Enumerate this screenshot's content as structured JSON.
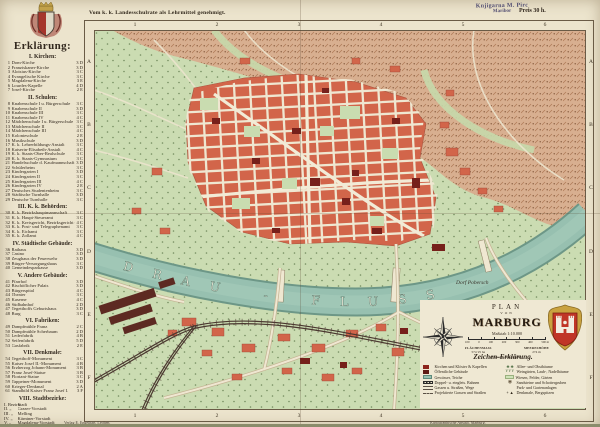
{
  "page": {
    "top_note": "Vom k. k. Landesschulrate als Lehrmittel genehmigt.",
    "stamp_line1": "Knjigarna M. Pirc",
    "stamp_line2": "Maribor",
    "price": "Preis 30 h.",
    "imprint_left": "Verlag E. Engelhart, Leoben.",
    "imprint_right": "Kartographische Anstalt, Marburg."
  },
  "legend": {
    "title": "Erklärung:",
    "sections": [
      {
        "title": "I. Kirchen:",
        "items": [
          {
            "n": "1",
            "label": "Dom-Kirche",
            "ref": "3 D"
          },
          {
            "n": "2",
            "label": "Franziskaner-Kirche",
            "ref": "3 D"
          },
          {
            "n": "3",
            "label": "Aloisius-Kirche",
            "ref": "3 C"
          },
          {
            "n": "4",
            "label": "Evangelische Kirche",
            "ref": "3 C"
          },
          {
            "n": "5",
            "label": "Magdalena-Kirche",
            "ref": "3 E"
          },
          {
            "n": "6",
            "label": "Lourdes-Kapelle",
            "ref": "4 D"
          },
          {
            "n": "7",
            "label": "Josef-Kirche",
            "ref": "2 E"
          }
        ]
      },
      {
        "title": "II. Schulen:",
        "items": [
          {
            "n": "8",
            "label": "Knabenschule I u. Bürgerschule",
            "ref": "3 C"
          },
          {
            "n": "9",
            "label": "Knabenschule II",
            "ref": "3 D"
          },
          {
            "n": "10",
            "label": "Knabenschule III",
            "ref": "3 C"
          },
          {
            "n": "11",
            "label": "Knabenschule IV",
            "ref": "4 C"
          },
          {
            "n": "12",
            "label": "Mädchenschule I u. Bürgerschule",
            "ref": "3 C"
          },
          {
            "n": "13",
            "label": "Mädchenschule II",
            "ref": "3 C"
          },
          {
            "n": "14",
            "label": "Mädchenschule III",
            "ref": "4 C"
          },
          {
            "n": "15",
            "label": "Kolonieschule",
            "ref": "2 E"
          },
          {
            "n": "16",
            "label": "Musikschule",
            "ref": "3 D"
          },
          {
            "n": "17",
            "label": "K. k. Lehrerbildungs-Anstalt",
            "ref": "3 C"
          },
          {
            "n": "18",
            "label": "Kaiserin-Elisabeth-Anstalt",
            "ref": "4 C"
          },
          {
            "n": "19",
            "label": "K. k. Staats-Ober-Realschule",
            "ref": "3 C"
          },
          {
            "n": "20",
            "label": "K. k. Staats-Gymnasium",
            "ref": "3 C"
          },
          {
            "n": "21",
            "label": "Handelsschule d. Kaufmannschaft",
            "ref": "3 D"
          },
          {
            "n": "22",
            "label": "Schülerheim",
            "ref": "3 C"
          },
          {
            "n": "23",
            "label": "Kindergarten I",
            "ref": "3 D"
          },
          {
            "n": "24",
            "label": "Kindergarten II",
            "ref": "3 C"
          },
          {
            "n": "25",
            "label": "Kindergarten III",
            "ref": "4 C"
          },
          {
            "n": "26",
            "label": "Kindergarten IV",
            "ref": "2 E"
          },
          {
            "n": "27",
            "label": "Deutsches Studentenheim",
            "ref": "3 C"
          },
          {
            "n": "28",
            "label": "Städtische Turnhalle",
            "ref": "3 D"
          },
          {
            "n": "29",
            "label": "Deutsche Turnhalle",
            "ref": "3 C"
          }
        ]
      },
      {
        "title": "III. K. k. Behörden:",
        "items": [
          {
            "n": "30",
            "label": "K. k. Bezirkshauptmannschaft",
            "ref": "3 C"
          },
          {
            "n": "31",
            "label": "K. k. Haupt-Steueramt",
            "ref": "3 C"
          },
          {
            "n": "32",
            "label": "K. k. Kreisgericht, Bezirksgericht und Gefangenhaus",
            "ref": "4 C"
          },
          {
            "n": "33",
            "label": "K. k. Post- und Telegraphenamt",
            "ref": "3 C"
          },
          {
            "n": "34",
            "label": "K. k. Eichamt",
            "ref": "3 C"
          },
          {
            "n": "35",
            "label": "K. k. Zollamt",
            "ref": "4 C"
          }
        ]
      },
      {
        "title": "IV. Städtische Gebäude:",
        "items": [
          {
            "n": "36",
            "label": "Rathaus",
            "ref": "3 D"
          },
          {
            "n": "37",
            "label": "Casino",
            "ref": "3 D"
          },
          {
            "n": "38",
            "label": "Zeughaus der Feuerwehr",
            "ref": "3 D"
          },
          {
            "n": "39",
            "label": "Bürger-Versorgungshaus",
            "ref": "3 C"
          },
          {
            "n": "40",
            "label": "Gemeindesparkasse",
            "ref": "3 D"
          }
        ]
      },
      {
        "title": "V. Andere Gebäude:",
        "items": [
          {
            "n": "41",
            "label": "Pfarrhof",
            "ref": "3 D"
          },
          {
            "n": "42",
            "label": "Bischöflicher Palais",
            "ref": "3 D"
          },
          {
            "n": "43",
            "label": "Bürgerspital",
            "ref": "4 C"
          },
          {
            "n": "44",
            "label": "Theater",
            "ref": "3 C"
          },
          {
            "n": "45",
            "label": "Kaserne",
            "ref": "4 C"
          },
          {
            "n": "46",
            "label": "Südbahnhof",
            "ref": "2 D"
          },
          {
            "n": "47",
            "label": "Tegetthoffs Geburtshaus",
            "ref": "3 D"
          },
          {
            "n": "48",
            "label": "Burg",
            "ref": "3 C"
          }
        ]
      },
      {
        "title": "VI. Fabriken:",
        "items": [
          {
            "n": "49",
            "label": "Dampfmühle Franz",
            "ref": "2 C"
          },
          {
            "n": "50",
            "label": "Dampfmühle Scherbaum",
            "ref": "2 D"
          },
          {
            "n": "51",
            "label": "Lederfabrik",
            "ref": "4 B"
          },
          {
            "n": "52",
            "label": "Seifenfabrik",
            "ref": "5 D"
          },
          {
            "n": "53",
            "label": "Gasfabrik",
            "ref": "2 E"
          }
        ]
      },
      {
        "title": "VII. Denkmale:",
        "items": [
          {
            "n": "54",
            "label": "Tegetthoff-Monument",
            "ref": "3 C"
          },
          {
            "n": "55",
            "label": "Kaiser Josef II.-Monument",
            "ref": "4 B"
          },
          {
            "n": "56",
            "label": "Erzherzog Johann-Monument",
            "ref": "3 B"
          },
          {
            "n": "57",
            "label": "Franz Josef-Statue",
            "ref": "3 B"
          },
          {
            "n": "58",
            "label": "Floriani-Statue",
            "ref": "3 C"
          },
          {
            "n": "59",
            "label": "Tappeiner-Monument",
            "ref": "3 D"
          },
          {
            "n": "60",
            "label": "Krieger-Denkmal",
            "ref": "2 A"
          },
          {
            "n": "61",
            "label": "Standbild Kaiser Franz Josef I.",
            "ref": "3 F"
          }
        ]
      },
      {
        "title": "VIII. Stadtbezirke:",
        "districts": [
          {
            "n": "I. Bezirk:",
            "label": "Stadt"
          },
          {
            "n": "II. „",
            "label": "Grazer-Vorstadt"
          },
          {
            "n": "III. „",
            "label": "Melling"
          },
          {
            "n": "IV. „",
            "label": "Kärntner-Vorstadt"
          },
          {
            "n": "V. „",
            "label": "Magdalena-Vorstadt"
          }
        ]
      }
    ]
  },
  "map": {
    "grid_cols": [
      "1",
      "2",
      "3",
      "4",
      "5",
      "6"
    ],
    "grid_rows": [
      "A",
      "B",
      "C",
      "D",
      "E",
      "F"
    ],
    "river_label": "DRAU - FLUSS",
    "village_label": "Dorf Pobersch"
  },
  "cartouche": {
    "plan": "PLAN",
    "von": "VON",
    "city": "MARBURG",
    "scale": "Maßstab 1:10.000",
    "scalebar": [
      "100",
      "0",
      "100",
      "200",
      "300",
      "400",
      "500 m"
    ],
    "area_label": "FLÄCHENMASS",
    "area_value": "574·25 ha",
    "elev_label": "MEERESHÖHE",
    "elev_value": "274 m",
    "pop": "Einwohnerzahl: 24.601",
    "legend_title": "Zeichen-Erklärung.",
    "left": [
      {
        "kind": "church",
        "label": "Kirchen und Klöster & Kapellen"
      },
      {
        "kind": "public",
        "label": "Öffentliche Gebäude"
      },
      {
        "kind": "water",
        "label": "Gewässer, Teiche"
      },
      {
        "kind": "rail",
        "label": "Doppel- u. eingleis. Bahnen"
      },
      {
        "kind": "street",
        "label": "Gassen u. Straßen, Wege"
      },
      {
        "kind": "projected",
        "label": "Projektierte Gassen und Straßen"
      }
    ],
    "right": [
      {
        "kind": "trees",
        "label": "Allee- und Obstbäume"
      },
      {
        "kind": "vine",
        "label": "Weingärten, Laub-, Nadelbäume"
      },
      {
        "kind": "meadow",
        "label": "Wiesen, Felder, Gärten"
      },
      {
        "kind": "quarry",
        "label": "Sandsteine und Schottergruben"
      },
      {
        "kind": "park",
        "label": "Park- und Gartenanlagen"
      },
      {
        "kind": "monument",
        "label": "Denkmale, Bergspitzen"
      }
    ]
  },
  "colors": {
    "paper": "#ece4cd",
    "green": "#cbdcb2",
    "hill": "#d8af90",
    "river": "#98c1b1",
    "city_red": "#d2654a",
    "dark_building": "#76201b",
    "arms_red": "#c03527"
  }
}
